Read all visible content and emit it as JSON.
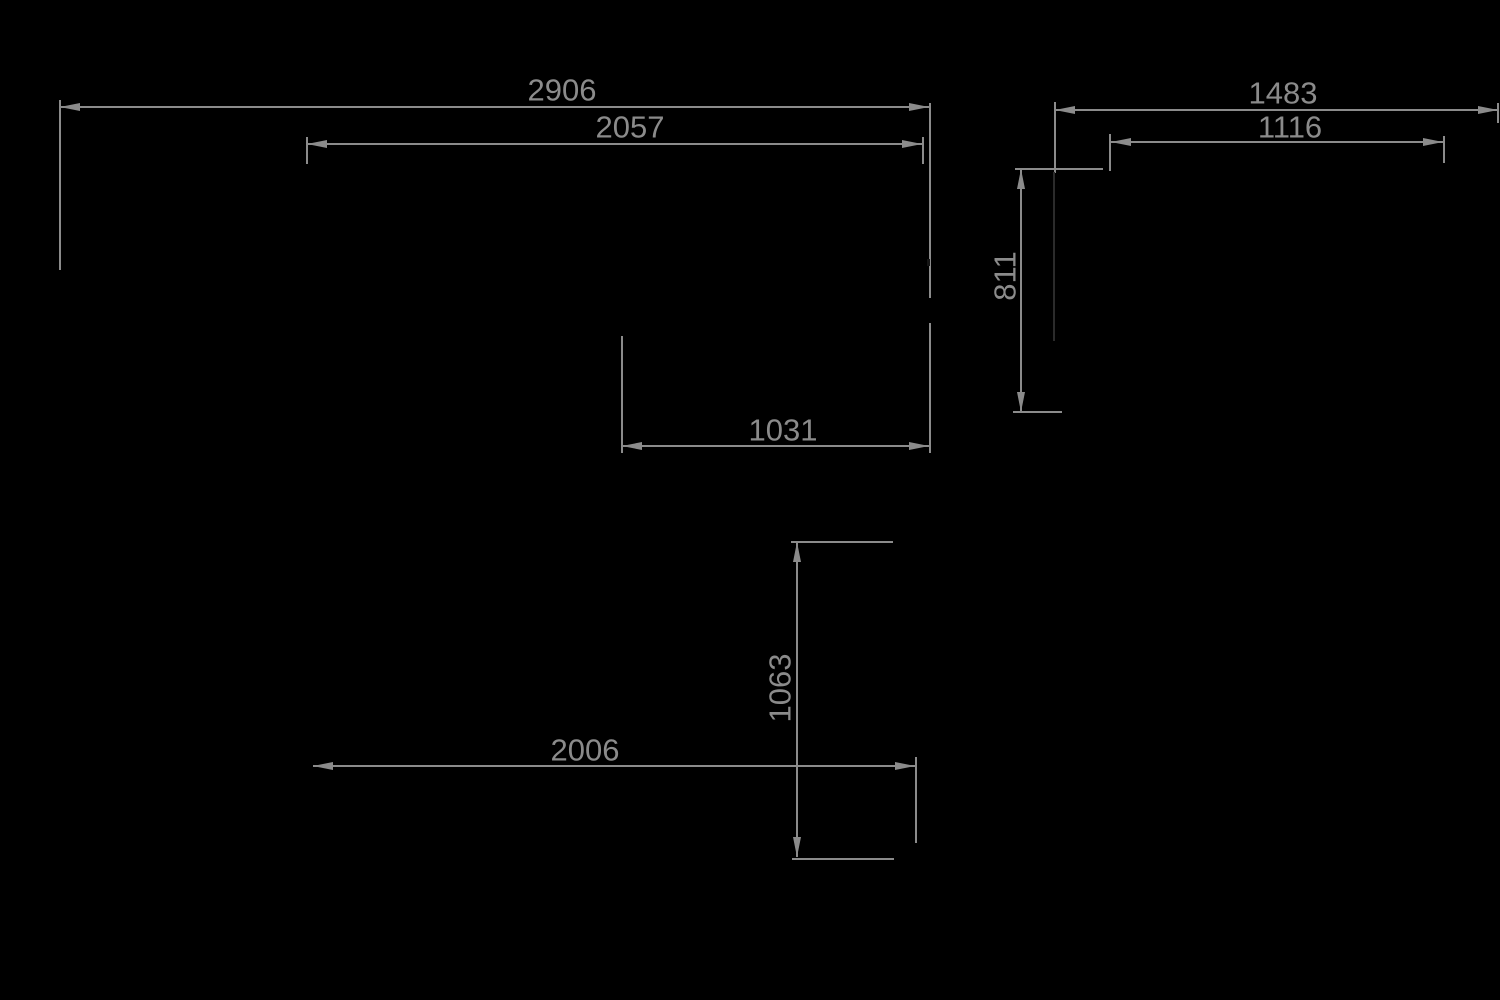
{
  "drawing": {
    "title": "dimension-drawing",
    "background": "#000000",
    "stroke_color": "#8b8b8b",
    "hidden_edge_color": "#2b2b2b",
    "text_color": "#8b8b8b",
    "font_size": 31,
    "stroke_width": 2,
    "arrow": {
      "length": 20,
      "half_width": 4
    },
    "measurements": [
      "2906",
      "2057",
      "1483",
      "1116",
      "811",
      "1031",
      "1063",
      "2006"
    ],
    "dim_lines": [
      {
        "name": "dim-line-2906",
        "axis": "h",
        "y": 107,
        "x1": 60,
        "x2": 929
      },
      {
        "name": "dim-line-2057",
        "axis": "h",
        "y": 144,
        "x1": 307,
        "x2": 922
      },
      {
        "name": "dim-line-1483",
        "axis": "h",
        "y": 110,
        "x1": 1055,
        "x2": 1498
      },
      {
        "name": "dim-line-1116",
        "axis": "h",
        "y": 142,
        "x1": 1111,
        "x2": 1443
      },
      {
        "name": "dim-line-1031",
        "axis": "h",
        "y": 446,
        "x1": 622,
        "x2": 929
      },
      {
        "name": "dim-line-2006",
        "axis": "h",
        "y": 766,
        "x1": 313,
        "x2": 915
      },
      {
        "name": "dim-line-811",
        "axis": "v",
        "x": 1021,
        "y1": 169,
        "y2": 412
      },
      {
        "name": "dim-line-1063",
        "axis": "v",
        "x": 797,
        "y1": 542,
        "y2": 857
      }
    ],
    "ext_lines": [
      {
        "name": "ext-2906-left",
        "x1": 60,
        "y1": 100,
        "x2": 60,
        "y2": 270
      },
      {
        "name": "ext-right-upper",
        "x1": 930,
        "y1": 103,
        "x2": 930,
        "y2": 298
      },
      {
        "name": "ext-right-lower",
        "x1": 930,
        "y1": 323,
        "x2": 930,
        "y2": 453
      },
      {
        "name": "ext-2057-left",
        "x1": 307,
        "y1": 137,
        "x2": 307,
        "y2": 164
      },
      {
        "name": "ext-2057-right",
        "x1": 923,
        "y1": 137,
        "x2": 923,
        "y2": 164
      },
      {
        "name": "ext-1031-left",
        "x1": 622,
        "y1": 336,
        "x2": 622,
        "y2": 453
      },
      {
        "name": "ext-1483-left",
        "x1": 1055,
        "y1": 102,
        "x2": 1055,
        "y2": 173
      },
      {
        "name": "ext-1483-right",
        "x1": 1498,
        "y1": 103,
        "x2": 1498,
        "y2": 123
      },
      {
        "name": "ext-1116-left",
        "x1": 1110,
        "y1": 134,
        "x2": 1110,
        "y2": 171
      },
      {
        "name": "ext-1116-right",
        "x1": 1444,
        "y1": 136,
        "x2": 1444,
        "y2": 163
      },
      {
        "name": "ext-811-top",
        "x1": 1015,
        "y1": 169,
        "x2": 1103,
        "y2": 169
      },
      {
        "name": "ext-811-bottom",
        "x1": 1013,
        "y1": 412,
        "x2": 1062,
        "y2": 412
      },
      {
        "name": "ext-1063-top",
        "x1": 791,
        "y1": 542,
        "x2": 893,
        "y2": 542
      },
      {
        "name": "ext-1063-bottom",
        "x1": 792,
        "y1": 859,
        "x2": 894,
        "y2": 859
      },
      {
        "name": "ext-2006-right",
        "x1": 916,
        "y1": 757,
        "x2": 916,
        "y2": 843
      }
    ],
    "hidden_lines": [
      {
        "name": "hidden-edge-right-view",
        "x1": 1054,
        "y1": 172,
        "x2": 1054,
        "y2": 341
      }
    ],
    "notches": [
      {
        "name": "notch-right-ext",
        "x": 927,
        "y": 259,
        "w": 3,
        "h": 7,
        "color": "#151515"
      }
    ],
    "labels": [
      {
        "name": "label-2906",
        "text": "2906",
        "x": 562,
        "y": 90,
        "rotate": 0
      },
      {
        "name": "label-2057",
        "text": "2057",
        "x": 630,
        "y": 127,
        "rotate": 0
      },
      {
        "name": "label-1483",
        "text": "1483",
        "x": 1283,
        "y": 93,
        "rotate": 0
      },
      {
        "name": "label-1116",
        "text": "1116",
        "x": 1290,
        "y": 127,
        "rotate": 0
      },
      {
        "name": "label-1031",
        "text": "1031",
        "x": 783,
        "y": 430,
        "rotate": 0
      },
      {
        "name": "label-811",
        "text": "811",
        "x": 1005,
        "y": 276,
        "rotate": -90
      },
      {
        "name": "label-1063",
        "text": "1063",
        "x": 780,
        "y": 688,
        "rotate": -90
      },
      {
        "name": "label-2006",
        "text": "2006",
        "x": 585,
        "y": 750,
        "rotate": 0
      }
    ]
  }
}
